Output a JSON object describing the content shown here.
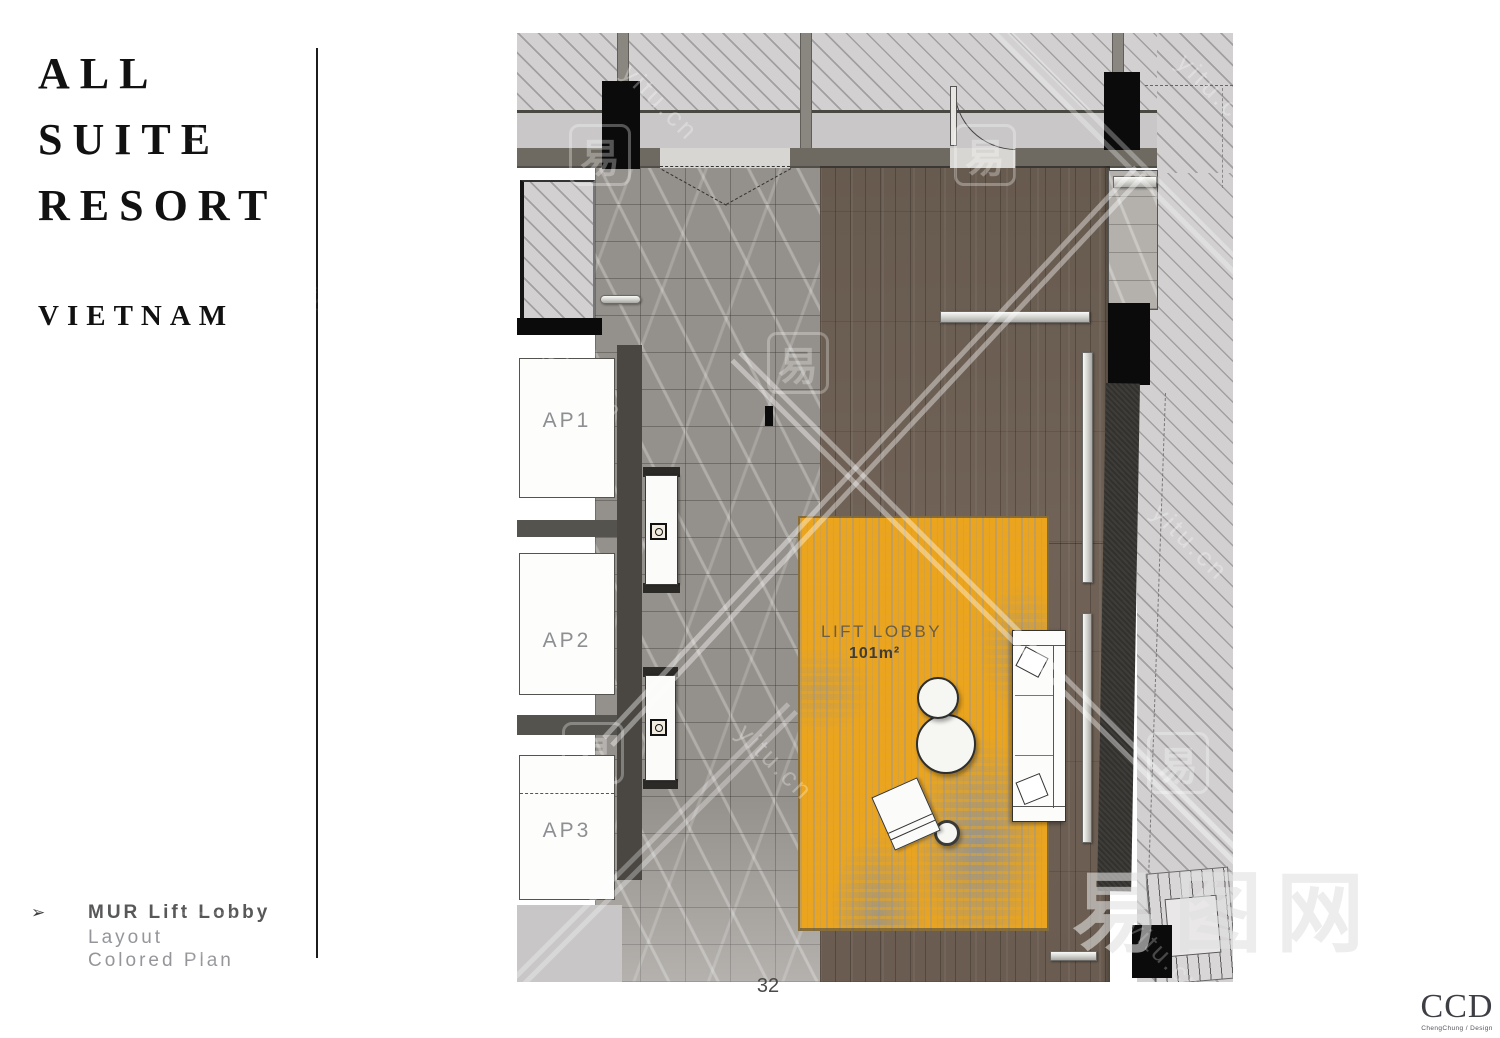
{
  "sidebar": {
    "title_lines": [
      "ALL",
      "SUITE",
      "RESORT"
    ],
    "subtitle": "VIETNAM",
    "footer": {
      "arrow_icon": "➢",
      "title": "MUR Lift Lobby",
      "line2": "Layout",
      "line3": "Colored Plan"
    }
  },
  "plan": {
    "rooms": [
      {
        "label": "AP1"
      },
      {
        "label": "AP2"
      },
      {
        "label": "AP3"
      }
    ],
    "lobby": {
      "name": "LIFT LOBBY",
      "area": "101m²"
    }
  },
  "page_number": "32",
  "logo": {
    "name": "CCD",
    "tagline": "ChengChung / Design"
  },
  "watermark": {
    "glyph": "易",
    "site": "yitu.cn",
    "brand": "易图网"
  },
  "colors": {
    "carpet": "#eaa41f",
    "marble": "#94908b",
    "marble_light": "#b4b1ac",
    "wood": "#6d5f54",
    "hatch": "#d2d0d1",
    "wall_band": "#6e6a62",
    "column_black": "#0b0b0b",
    "divider": "#1c1c1c"
  }
}
